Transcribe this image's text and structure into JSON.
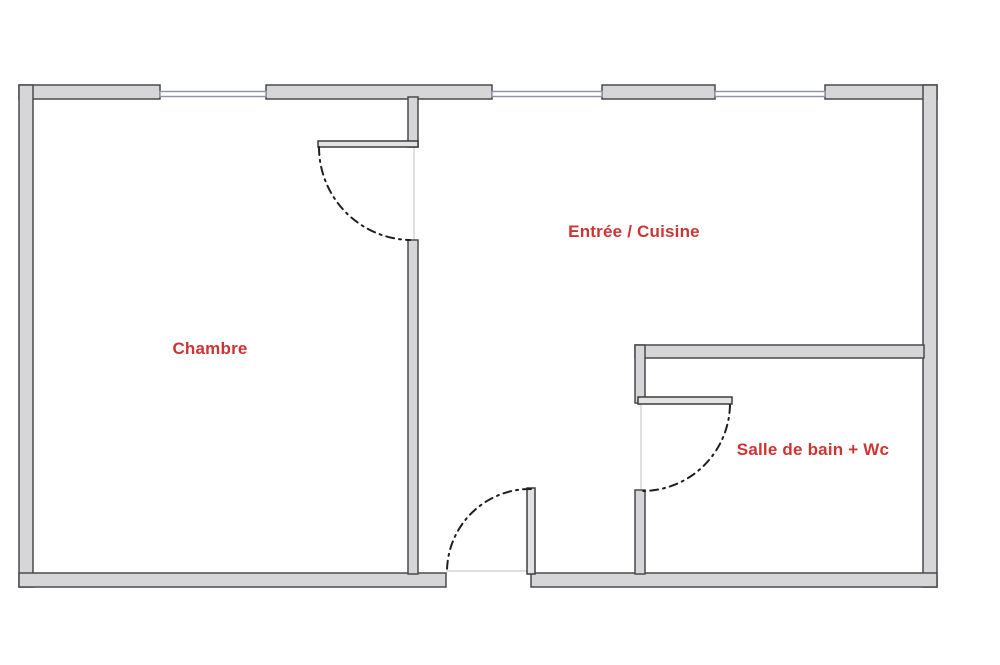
{
  "plan": {
    "background": "#ffffff",
    "wall_fill": "#d6d6d8",
    "wall_stroke": "#4a4a4a",
    "leaf_fill": "#e2e2e4",
    "leaf_stroke": "#3c3c3c",
    "window_color": "#8f91ac",
    "arc_color": "#1f1f1f",
    "threshold_color": "#cccccc",
    "label_color": "#cf3434",
    "exterior_walls": [
      {
        "name": "top-wall-segment-1",
        "x": 19,
        "y": 85,
        "w": 141,
        "h": 14
      },
      {
        "name": "top-wall-segment-2",
        "x": 266,
        "y": 85,
        "w": 226,
        "h": 14
      },
      {
        "name": "top-wall-segment-3",
        "x": 602,
        "y": 85,
        "w": 113,
        "h": 14
      },
      {
        "name": "top-wall-segment-4",
        "x": 825,
        "y": 85,
        "w": 112,
        "h": 14
      },
      {
        "name": "left-wall",
        "x": 19,
        "y": 85,
        "w": 14,
        "h": 502
      },
      {
        "name": "right-wall",
        "x": 923,
        "y": 85,
        "w": 14,
        "h": 502
      },
      {
        "name": "bottom-wall-left",
        "x": 19,
        "y": 573,
        "w": 427,
        "h": 14
      },
      {
        "name": "bottom-wall-right",
        "x": 531,
        "y": 573,
        "w": 406,
        "h": 14
      }
    ],
    "interior_walls": [
      {
        "name": "divider-wall-upper",
        "x": 408,
        "y": 97,
        "w": 10,
        "h": 50
      },
      {
        "name": "divider-wall-lower",
        "x": 408,
        "y": 240,
        "w": 10,
        "h": 334
      },
      {
        "name": "bathroom-top-wall",
        "x": 635,
        "y": 345,
        "w": 289,
        "h": 13
      },
      {
        "name": "bathroom-left-wall-upper",
        "x": 635,
        "y": 345,
        "w": 10,
        "h": 58
      },
      {
        "name": "bathroom-left-wall-lower",
        "x": 635,
        "y": 490,
        "w": 10,
        "h": 84
      }
    ],
    "door_leaves": [
      {
        "name": "chambre-door-leaf",
        "x": 318,
        "y": 141,
        "w": 100,
        "h": 6
      },
      {
        "name": "bathroom-door-leaf",
        "x": 638,
        "y": 397,
        "w": 94,
        "h": 7
      },
      {
        "name": "entrance-door-leaf",
        "x": 527,
        "y": 488,
        "w": 8,
        "h": 86
      }
    ],
    "windows": [
      {
        "name": "window-1",
        "x": 160,
        "y": 91.5,
        "w": 106,
        "h": 5
      },
      {
        "name": "window-2",
        "x": 492,
        "y": 91.5,
        "w": 110,
        "h": 5
      },
      {
        "name": "window-3",
        "x": 715,
        "y": 91.5,
        "w": 110,
        "h": 5
      }
    ],
    "door_arcs": [
      {
        "name": "chambre-door-arc",
        "d": "M 319 147 A 93 93 0 0 0 410 240"
      },
      {
        "name": "bathroom-door-arc",
        "d": "M 730 405 A 88 88 0 0 1 640 491"
      },
      {
        "name": "entrance-door-arc",
        "d": "M 531 489 A 83 83 0 0 0 447 571"
      }
    ],
    "thresholds": [
      {
        "name": "chambre-door-threshold",
        "x1": 414,
        "y1": 147,
        "x2": 414,
        "y2": 240
      },
      {
        "name": "bathroom-door-threshold",
        "x1": 641,
        "y1": 404,
        "x2": 641,
        "y2": 490
      },
      {
        "name": "entrance-door-threshold",
        "x1": 446,
        "y1": 571,
        "x2": 531,
        "y2": 571
      }
    ]
  },
  "rooms": [
    {
      "name": "Chambre"
    },
    {
      "name": "Entrée / Cuisine"
    },
    {
      "name": "Salle de bain + Wc"
    }
  ]
}
